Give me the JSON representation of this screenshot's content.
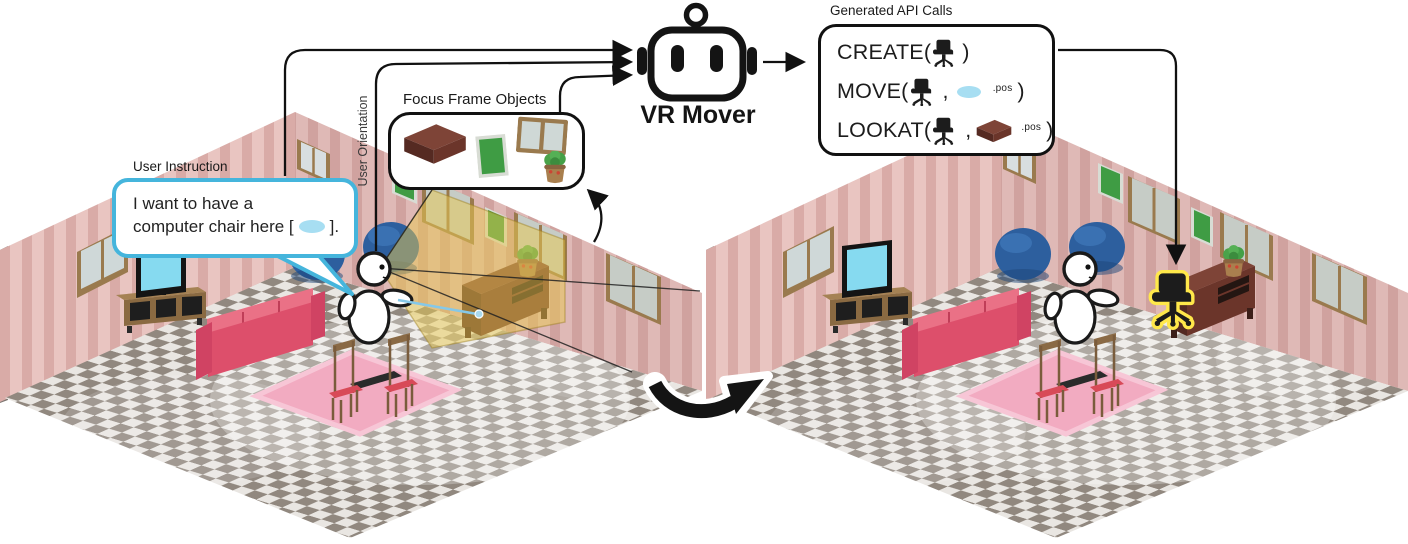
{
  "figure_type": "vr-system-pipeline-diagram",
  "labels": {
    "user_instruction": "User Instruction",
    "user_orientation": "User Orientation",
    "focus_frame_objects": "Focus Frame Objects",
    "generated_api_calls": "Generated API Calls",
    "robot_name": "VR Mover"
  },
  "speech_bubble": {
    "line1": "I want to have a",
    "line2_before": "computer chair here [",
    "line2_after": "]."
  },
  "api_calls": {
    "rows": [
      {
        "fn": "CREATE",
        "open": "(",
        "args": [
          "office-chair-icon"
        ],
        "close": ")"
      },
      {
        "fn": "MOVE",
        "open": "(",
        "args": [
          "office-chair-icon",
          "position-ellipse-icon"
        ],
        "comma": ",",
        "pos_suffix": ".pos",
        "close": ")"
      },
      {
        "fn": "LOOKAT",
        "open": "(",
        "args": [
          "office-chair-icon",
          "desk-icon"
        ],
        "comma": ",",
        "pos_suffix": ".pos",
        "close": ")"
      }
    ]
  },
  "focus_frame_icons": [
    "desk-icon",
    "green-board-icon",
    "window-icon",
    "plant-icon"
  ],
  "scenes": {
    "left": {
      "objects": [
        "pink-striped-walls",
        "checkered-floor",
        "windows",
        "green-boards",
        "tv-on-stand",
        "red-sofa",
        "pink-rug",
        "kids-table-and-chairs",
        "bean-bags",
        "desk-with-plant",
        "user-avatar",
        "yellow-view-frustum",
        "blue-pointer-ray",
        "speech-bubble"
      ]
    },
    "right": {
      "objects": [
        "pink-striped-walls",
        "checkered-floor",
        "windows",
        "green-boards",
        "tv-on-stand",
        "red-sofa",
        "pink-rug",
        "kids-table-and-chairs",
        "bean-bags",
        "desk-with-plant",
        "user-avatar",
        "new-office-chair-highlighted"
      ]
    }
  },
  "colors": {
    "bubble_border": "#45b5dc",
    "highlight_yellow": "#ffe84a",
    "position_ellipse": "#a7def2",
    "frustum_yellow": "#e8c84f",
    "wall_pink": "#e9c5c1",
    "wall_stripe": "#d9aba7",
    "floor_light": "#e9e6e2",
    "floor_dark": "#91887f",
    "sofa_red": "#dd4f6b",
    "rug_pink": "#f2abc1",
    "bean_bag_blue": "#2d5f9e",
    "board_green": "#3f9c44",
    "desk_brown": "#7e4437",
    "tv_screen_cyan": "#86daf0",
    "chair_black": "#1c1c1c"
  }
}
